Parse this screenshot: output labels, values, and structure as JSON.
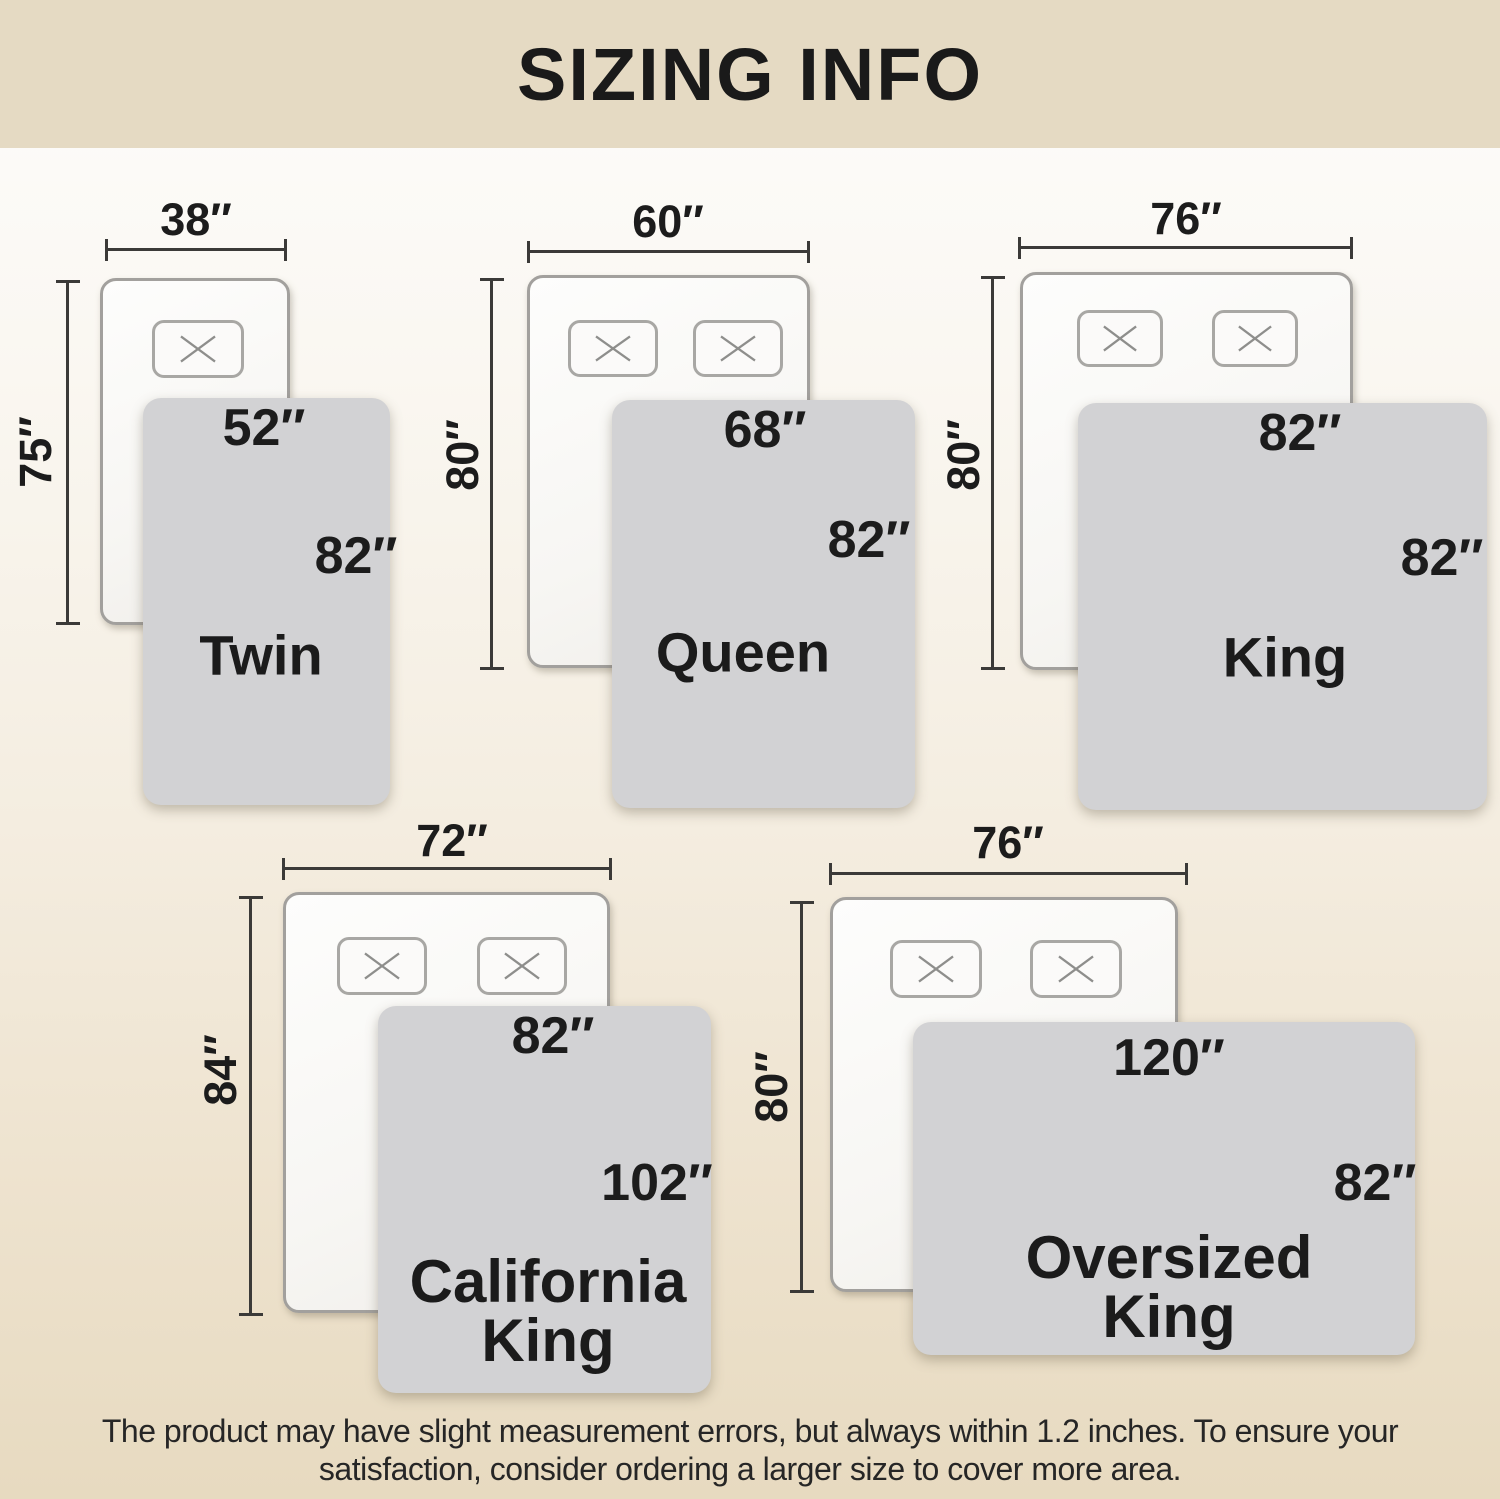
{
  "title": "SIZING INFO",
  "footer": {
    "line1": "The product may have slight measurement errors, but always within 1.2 inches. To ensure your",
    "line2": "satisfaction, consider ordering a larger size to cover more area."
  },
  "sizes": [
    {
      "id": "twin",
      "name_lines": [
        "Twin"
      ],
      "bed_width": "38″",
      "bed_length": "75″",
      "blanket_width": "52″",
      "blanket_length": "82″"
    },
    {
      "id": "queen",
      "name_lines": [
        "Queen"
      ],
      "bed_width": "60″",
      "bed_length": "80″",
      "blanket_width": "68″",
      "blanket_length": "82″"
    },
    {
      "id": "king",
      "name_lines": [
        "King"
      ],
      "bed_width": "76″",
      "bed_length": "80″",
      "blanket_width": "82″",
      "blanket_length": "82″"
    },
    {
      "id": "california-king",
      "name_lines": [
        "California",
        "King"
      ],
      "bed_width": "72″",
      "bed_length": "84″",
      "blanket_width": "82″",
      "blanket_length": "102″"
    },
    {
      "id": "oversized-king",
      "name_lines": [
        "Oversized",
        "King"
      ],
      "bed_width": "76″",
      "bed_length": "80″",
      "blanket_width": "120″",
      "blanket_length": "82″"
    }
  ],
  "colors": {
    "header_background": "#e5dac3",
    "page_top": "#fdfdfc",
    "page_bottom": "#e7dac0",
    "blanket": "#d2d2d4",
    "dimension_line": "#3b3a38",
    "text": "#1c1c1c"
  }
}
